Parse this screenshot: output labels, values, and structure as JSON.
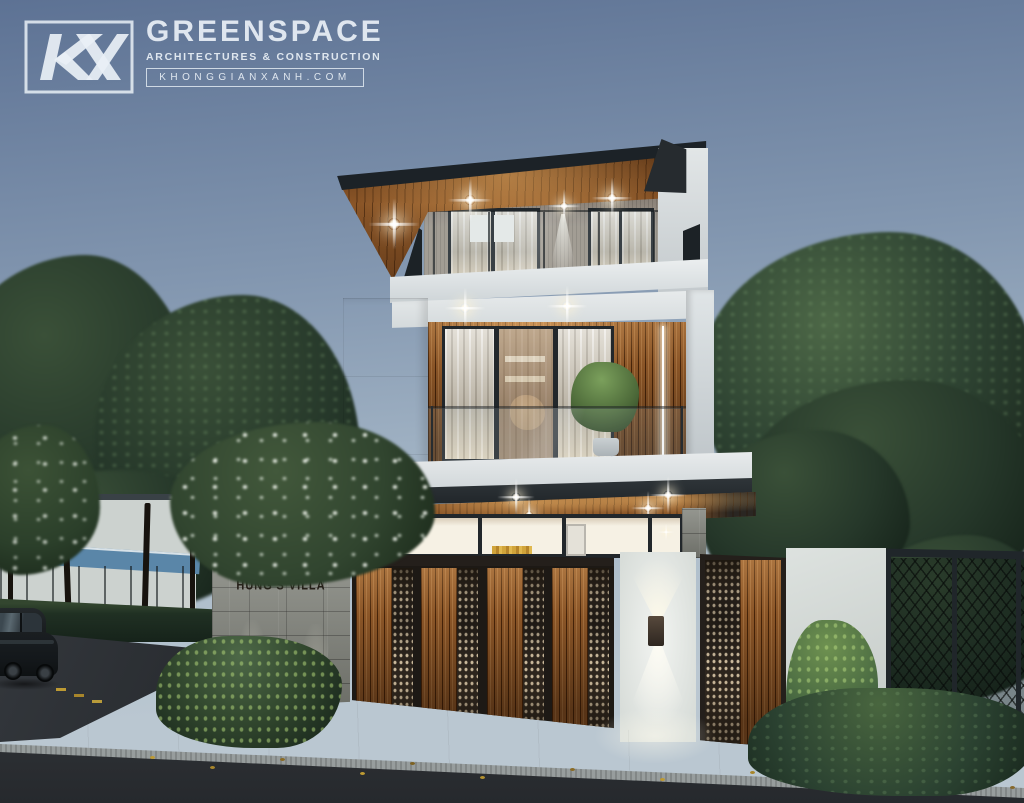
{
  "watermark": {
    "monogram": "KGX",
    "brand": "GREENSPACE",
    "tagline": "ARCHITECTURES & CONSTRUCTION",
    "website": "KHONGGIANXANH.COM"
  },
  "scene": {
    "type": "architectural exterior rendering",
    "subject": "modern three-storey villa at dusk",
    "house_sign": "HUNG'S VILLA",
    "colors": {
      "sky-top": "#5d7294",
      "sky-mid": "#8397b0",
      "sky-low": "#a9bac9",
      "sky-horizon": "#bac7d1",
      "foliage-dark": "#1d2b20",
      "foliage-mid": "#2e4332",
      "foliage-light": "#4d6847",
      "wood-light": "#b07a42",
      "wood-mid": "#8a5527",
      "wood-dark": "#5e3512",
      "white-wall": "#e6eaeb",
      "white-bright": "#f2f4f1",
      "stone": "#84867e",
      "frame-dark": "#22272b",
      "perf-dark": "#362d24",
      "glass-cool": "#c3cdd2",
      "curtain": "#d5cfc2",
      "interior-warm": "#f6f1e4",
      "light-warm": "#ffe9c4",
      "road": "#26292d",
      "road-far": "#33373c",
      "sidewalk": "#dfe2dd",
      "curb": "#979d9d",
      "leaf-yellow": "#bd9a33",
      "awning-blue": "#5a86a8",
      "car-body": "#14181b"
    }
  }
}
